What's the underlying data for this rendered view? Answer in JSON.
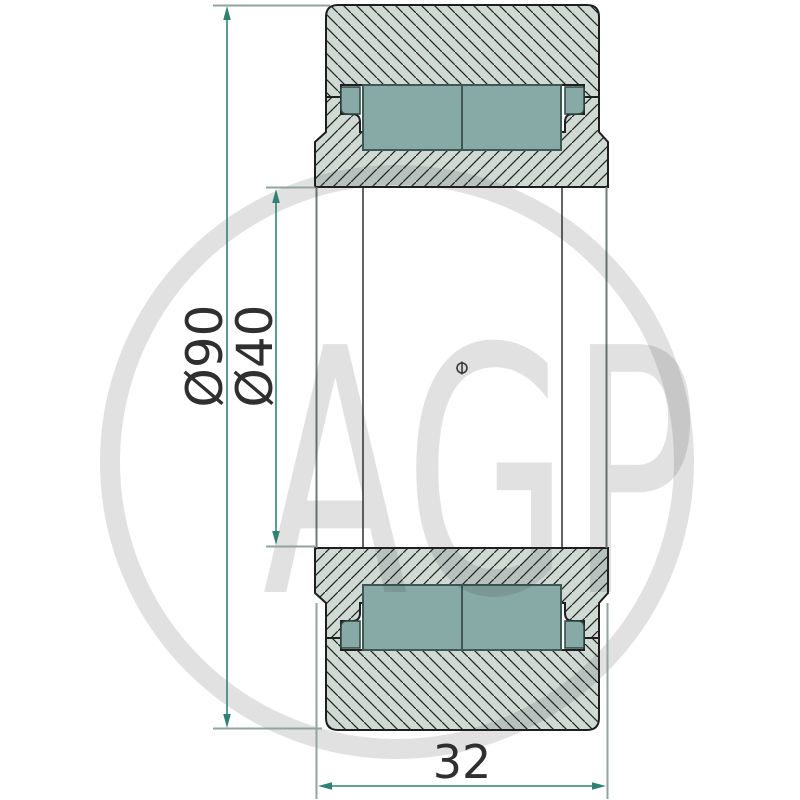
{
  "title": "Bearing cross-section technical drawing",
  "watermark": {
    "text": "AGP"
  },
  "dimensions": {
    "outer_diameter": {
      "label": "Ø90"
    },
    "bore_diameter": {
      "label": "Ø40"
    },
    "width": {
      "label": "32"
    }
  },
  "colors": {
    "section_fill": "#cfdad5",
    "hatch_line": "#262626",
    "roller_fill": "#88aaa6",
    "roller_stroke": "#3d5854",
    "outline": "#1f1f1f",
    "dimension_line": "#2f8273",
    "extension_line": "#93a39d",
    "label_text": "#2f2f2f",
    "watermark_gray": "#dddddd"
  }
}
